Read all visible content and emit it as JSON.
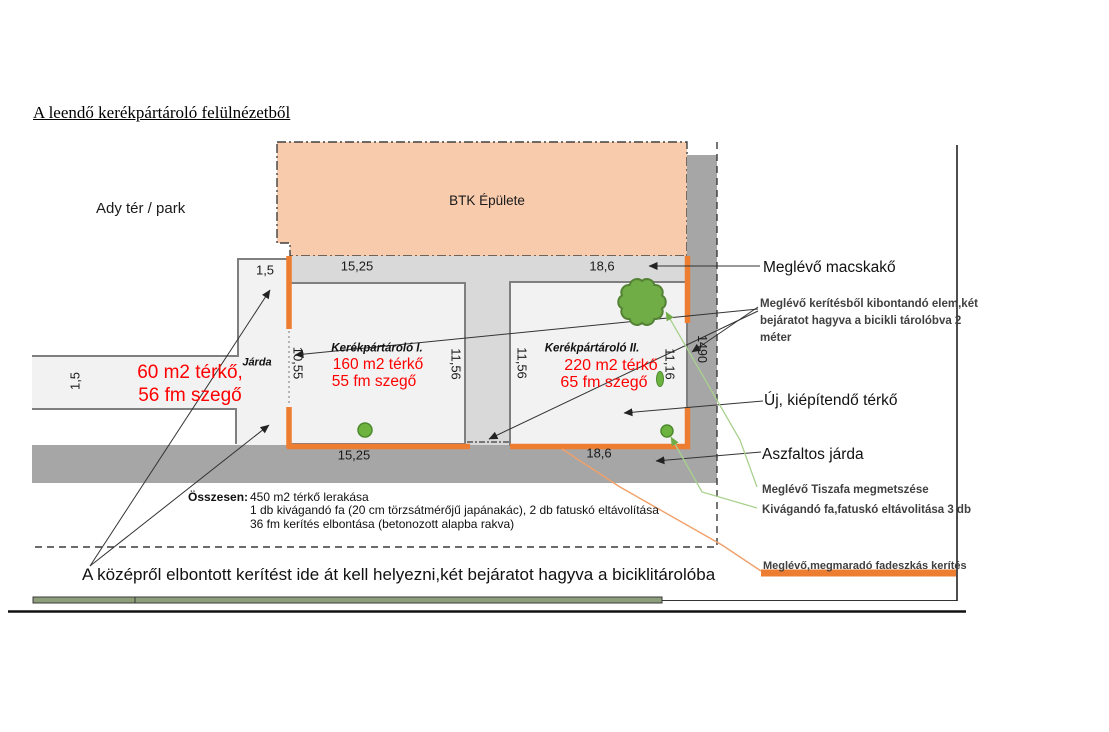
{
  "title": "A leendő kerékpártároló felülnézetből",
  "park_label": "Ady tér / park",
  "building_label": "BTK Épülete",
  "jarda_label": "Járda",
  "red_left": {
    "line1": "60 m2 térkő,",
    "line2": "56 fm szegő"
  },
  "storage1": {
    "name": "Kerékpártároló I.",
    "line1": "160 m2 térkő",
    "line2": "55 fm szegő"
  },
  "storage2": {
    "name": "Kerékpártároló II.",
    "line1": "220 m2 térkő",
    "line2": "65 fm szegő"
  },
  "dimensions": {
    "jarda_top": "1,5",
    "s1_top": "15,25",
    "s2_top": "18,6",
    "s1_bottom": "15,25",
    "s2_bottom": "18,6",
    "sidewalk": "1,5",
    "s1_left": "10,55",
    "s1_right": "11,56",
    "s2_left": "11,56",
    "s2_right": "11,16",
    "right_strip": "1490"
  },
  "annotations": {
    "macskako": "Meglévő macskakő",
    "kerites_elem": [
      "Meglévő kerítésből kibontandó elem,két",
      "bejáratot hagyva a bicikli tárolóbva 2",
      "méter"
    ],
    "uj_terko": "Új, kiépítendő térkő",
    "aszfalt": "Aszfaltos járda",
    "tiszafa": "Meglévő Tiszafa megmetszése",
    "kivagando": "Kivágandó fa,fatuskó eltávolitása 3 db",
    "fadeszkas": "Meglévő,megmaradó fadeszkás kerítés"
  },
  "summary": {
    "label": "Összesen:",
    "lines": [
      "450 m2 térkő lerakása",
      "1 db kivágandó fa (20 cm törzsátmérőjű japánakác), 2 db fatuskó eltávolítása",
      "36 fm kerítés elbontása (betonozott alapba rakva)"
    ]
  },
  "bottom_note": "A középről elbontott kerítést ide át kell helyezni,két bejáratot hagyva a biciklitárolóba",
  "colors": {
    "building_peach": "#F8CBAD",
    "fence_orange": "#ED7D31",
    "cobble_gray": "#D9D9D9",
    "paving_gray": "#F2F2F2",
    "asphalt_gray": "#A6A6A6",
    "red_text": "#FF0000",
    "tree_green": "#70AD47"
  }
}
